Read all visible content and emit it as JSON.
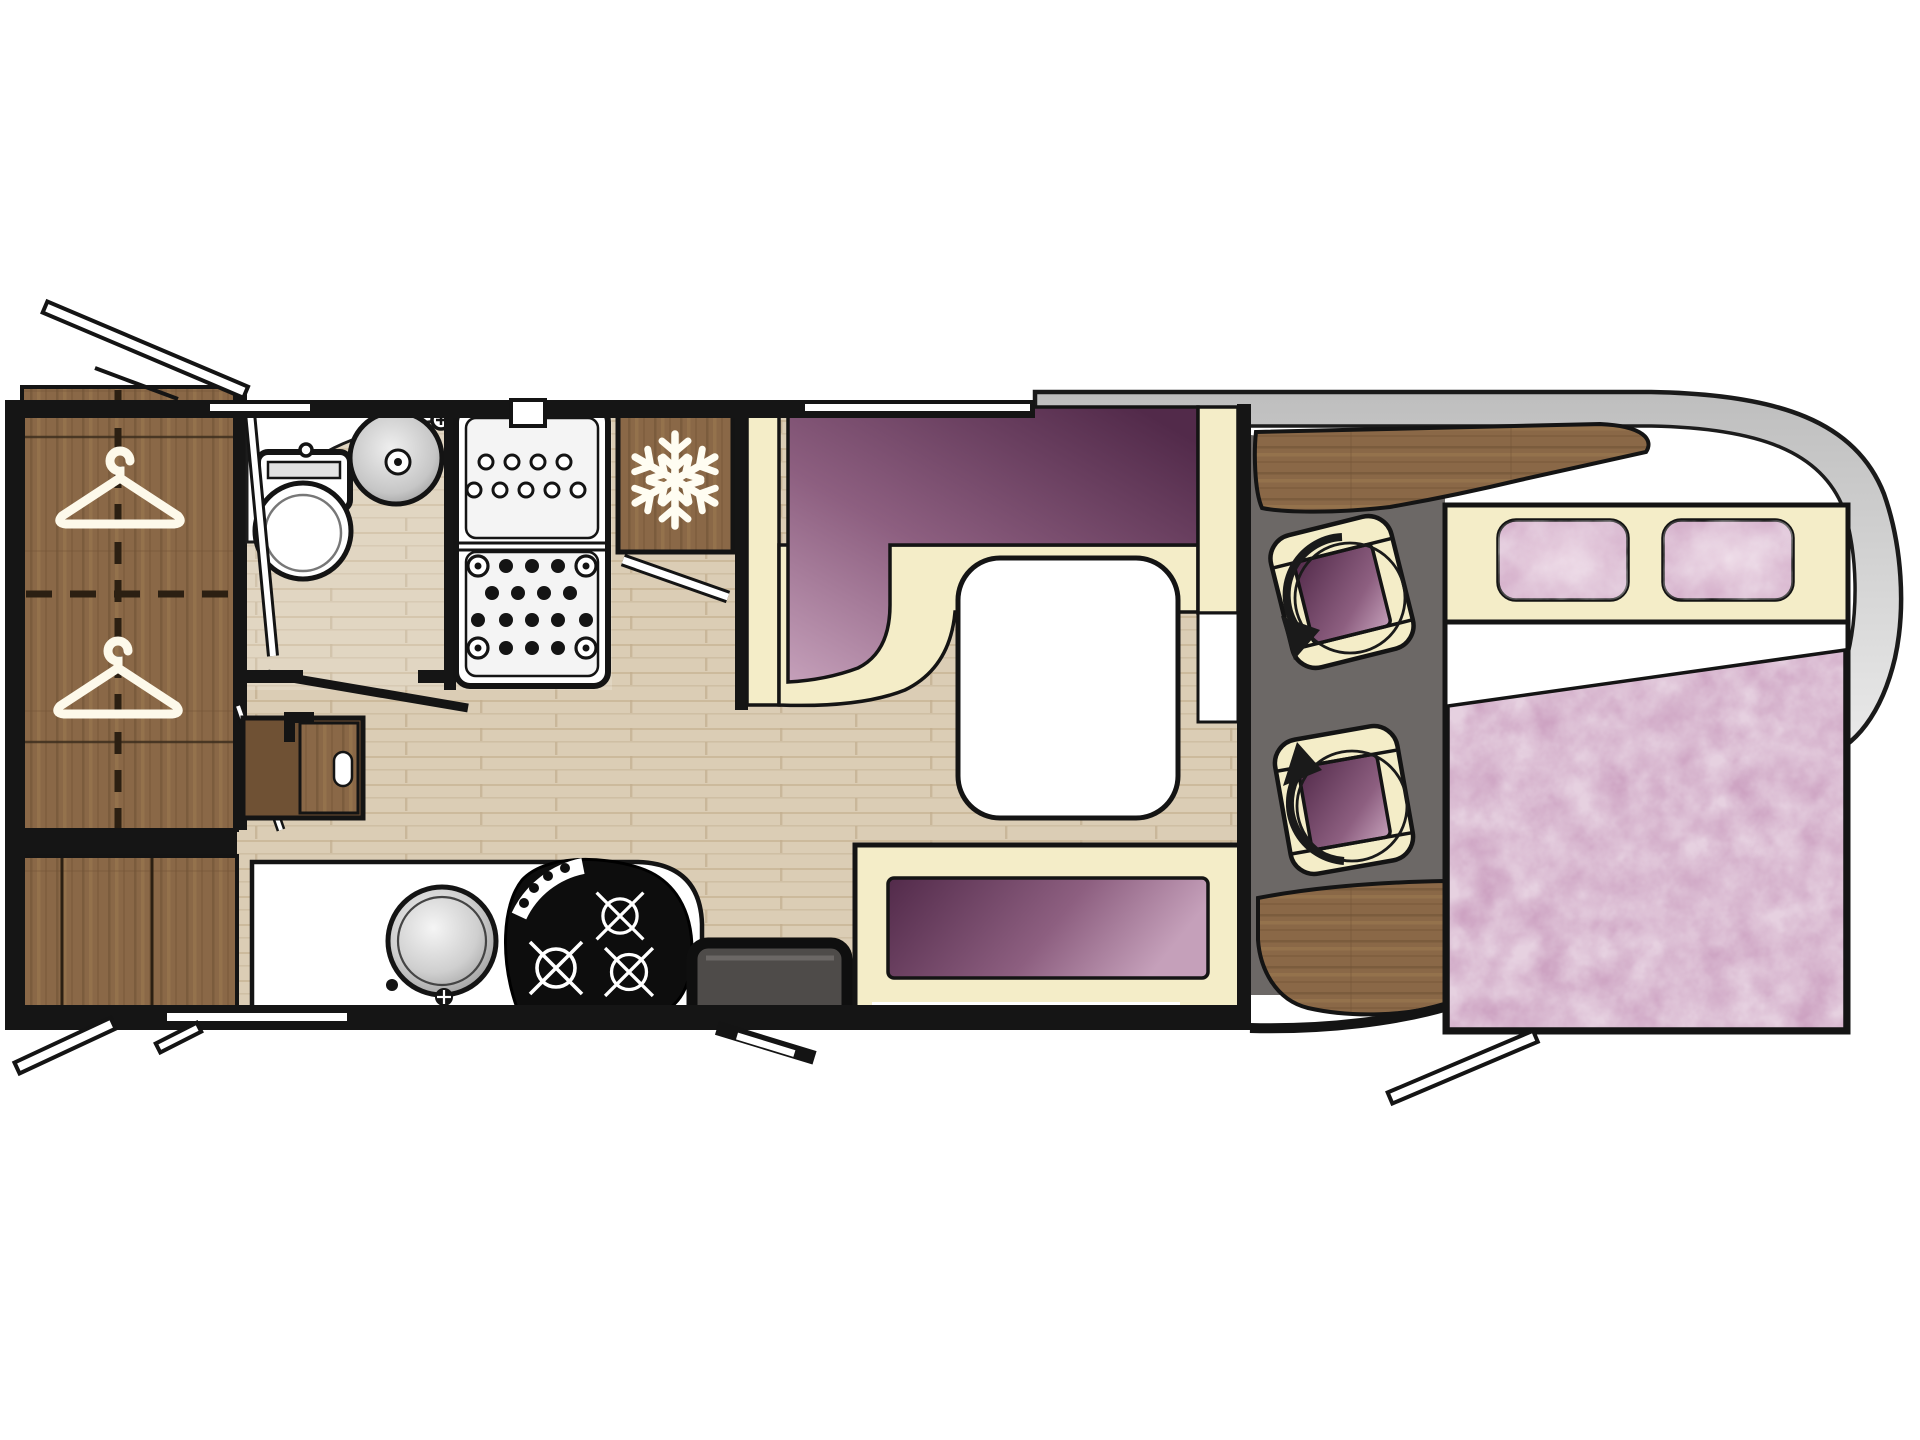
{
  "plan": {
    "label": "Motorhome floor plan - top view",
    "orientation": "vehicle cab and over-cab double bed on the right",
    "rooms": [
      {
        "id": "wardrobe",
        "label": "Wardrobe with two clothes hangers",
        "icon": "clothes-hanger-icon"
      },
      {
        "id": "bathroom",
        "label": "Washroom with toilet and round basin"
      },
      {
        "id": "shower",
        "label": "Shower cubicle with drain tray"
      },
      {
        "id": "fridge",
        "label": "Refrigerator / freezer cabinet",
        "icon": "snowflake-icon"
      },
      {
        "id": "dinette",
        "label": "L-shaped lounge seating with white table"
      },
      {
        "id": "side-bench",
        "label": "Side bench seat with purple cushion"
      },
      {
        "id": "kitchen",
        "label": "Kitchen block with round sink and 3-burner hob"
      },
      {
        "id": "entry",
        "label": "Entrance door with dark step"
      },
      {
        "id": "cab",
        "label": "Driver cab with two swivel captain seats",
        "icon": "swivel-arrow-icon"
      },
      {
        "id": "bed",
        "label": "Double bed with two pillows over the cab"
      }
    ],
    "counts": {
      "hangers": 2,
      "swivel_seats": 2,
      "pillows": 2,
      "hob_burners": 3,
      "windows": 3
    }
  },
  "colors": {
    "wall": "#151515",
    "floor": "#DBCDB5",
    "floor_streak": "#C9B698",
    "wood": "#8A6847",
    "wood_dark": "#6F5134",
    "wood_light": "#9E7C52",
    "cream": "#F4EDC8",
    "purple_dark": "#522A4A",
    "purple_mid": "#8D5F80",
    "purple_light": "#C5A0BA",
    "pink": "#CDA3C2",
    "pink_light": "#E8D0E0",
    "gray_floor": "#6C6866",
    "hood": "#BEBEBE",
    "hood_light": "#EBEBEB",
    "step": "#4E4B49",
    "sink_dark": "#8F8F8F",
    "sink_light": "#F5F5F5"
  }
}
